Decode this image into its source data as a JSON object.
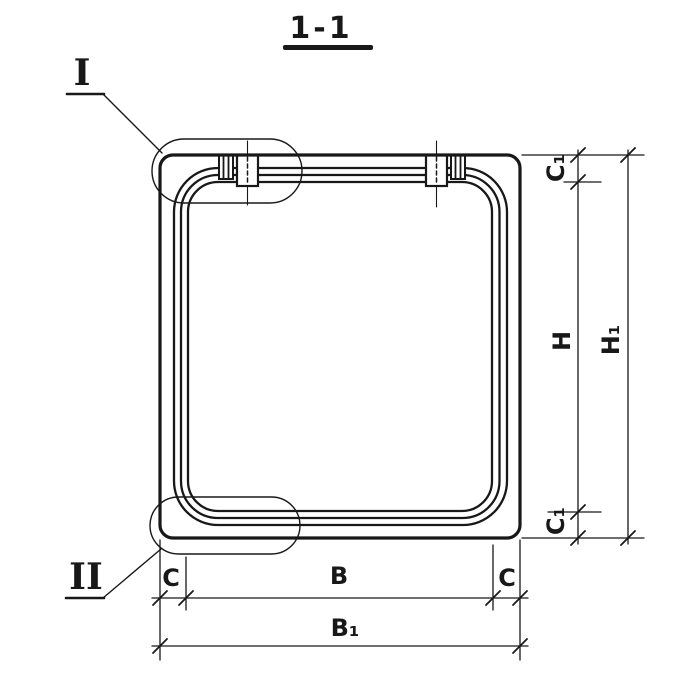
{
  "drawing": {
    "title": "1-1",
    "detail_markers": {
      "detail_1": "I",
      "detail_2": "II"
    },
    "dimensions": {
      "right_top_slab": "C₁",
      "right_clear_height": "H",
      "right_bottom_slab": "C₁",
      "right_overall_height": "H₁",
      "bottom_left_wall": "C",
      "bottom_clear_width": "B",
      "bottom_right_wall": "C",
      "bottom_overall_width": "B₁"
    },
    "colors": {
      "line": "#181818",
      "background": "#ffffff"
    }
  }
}
